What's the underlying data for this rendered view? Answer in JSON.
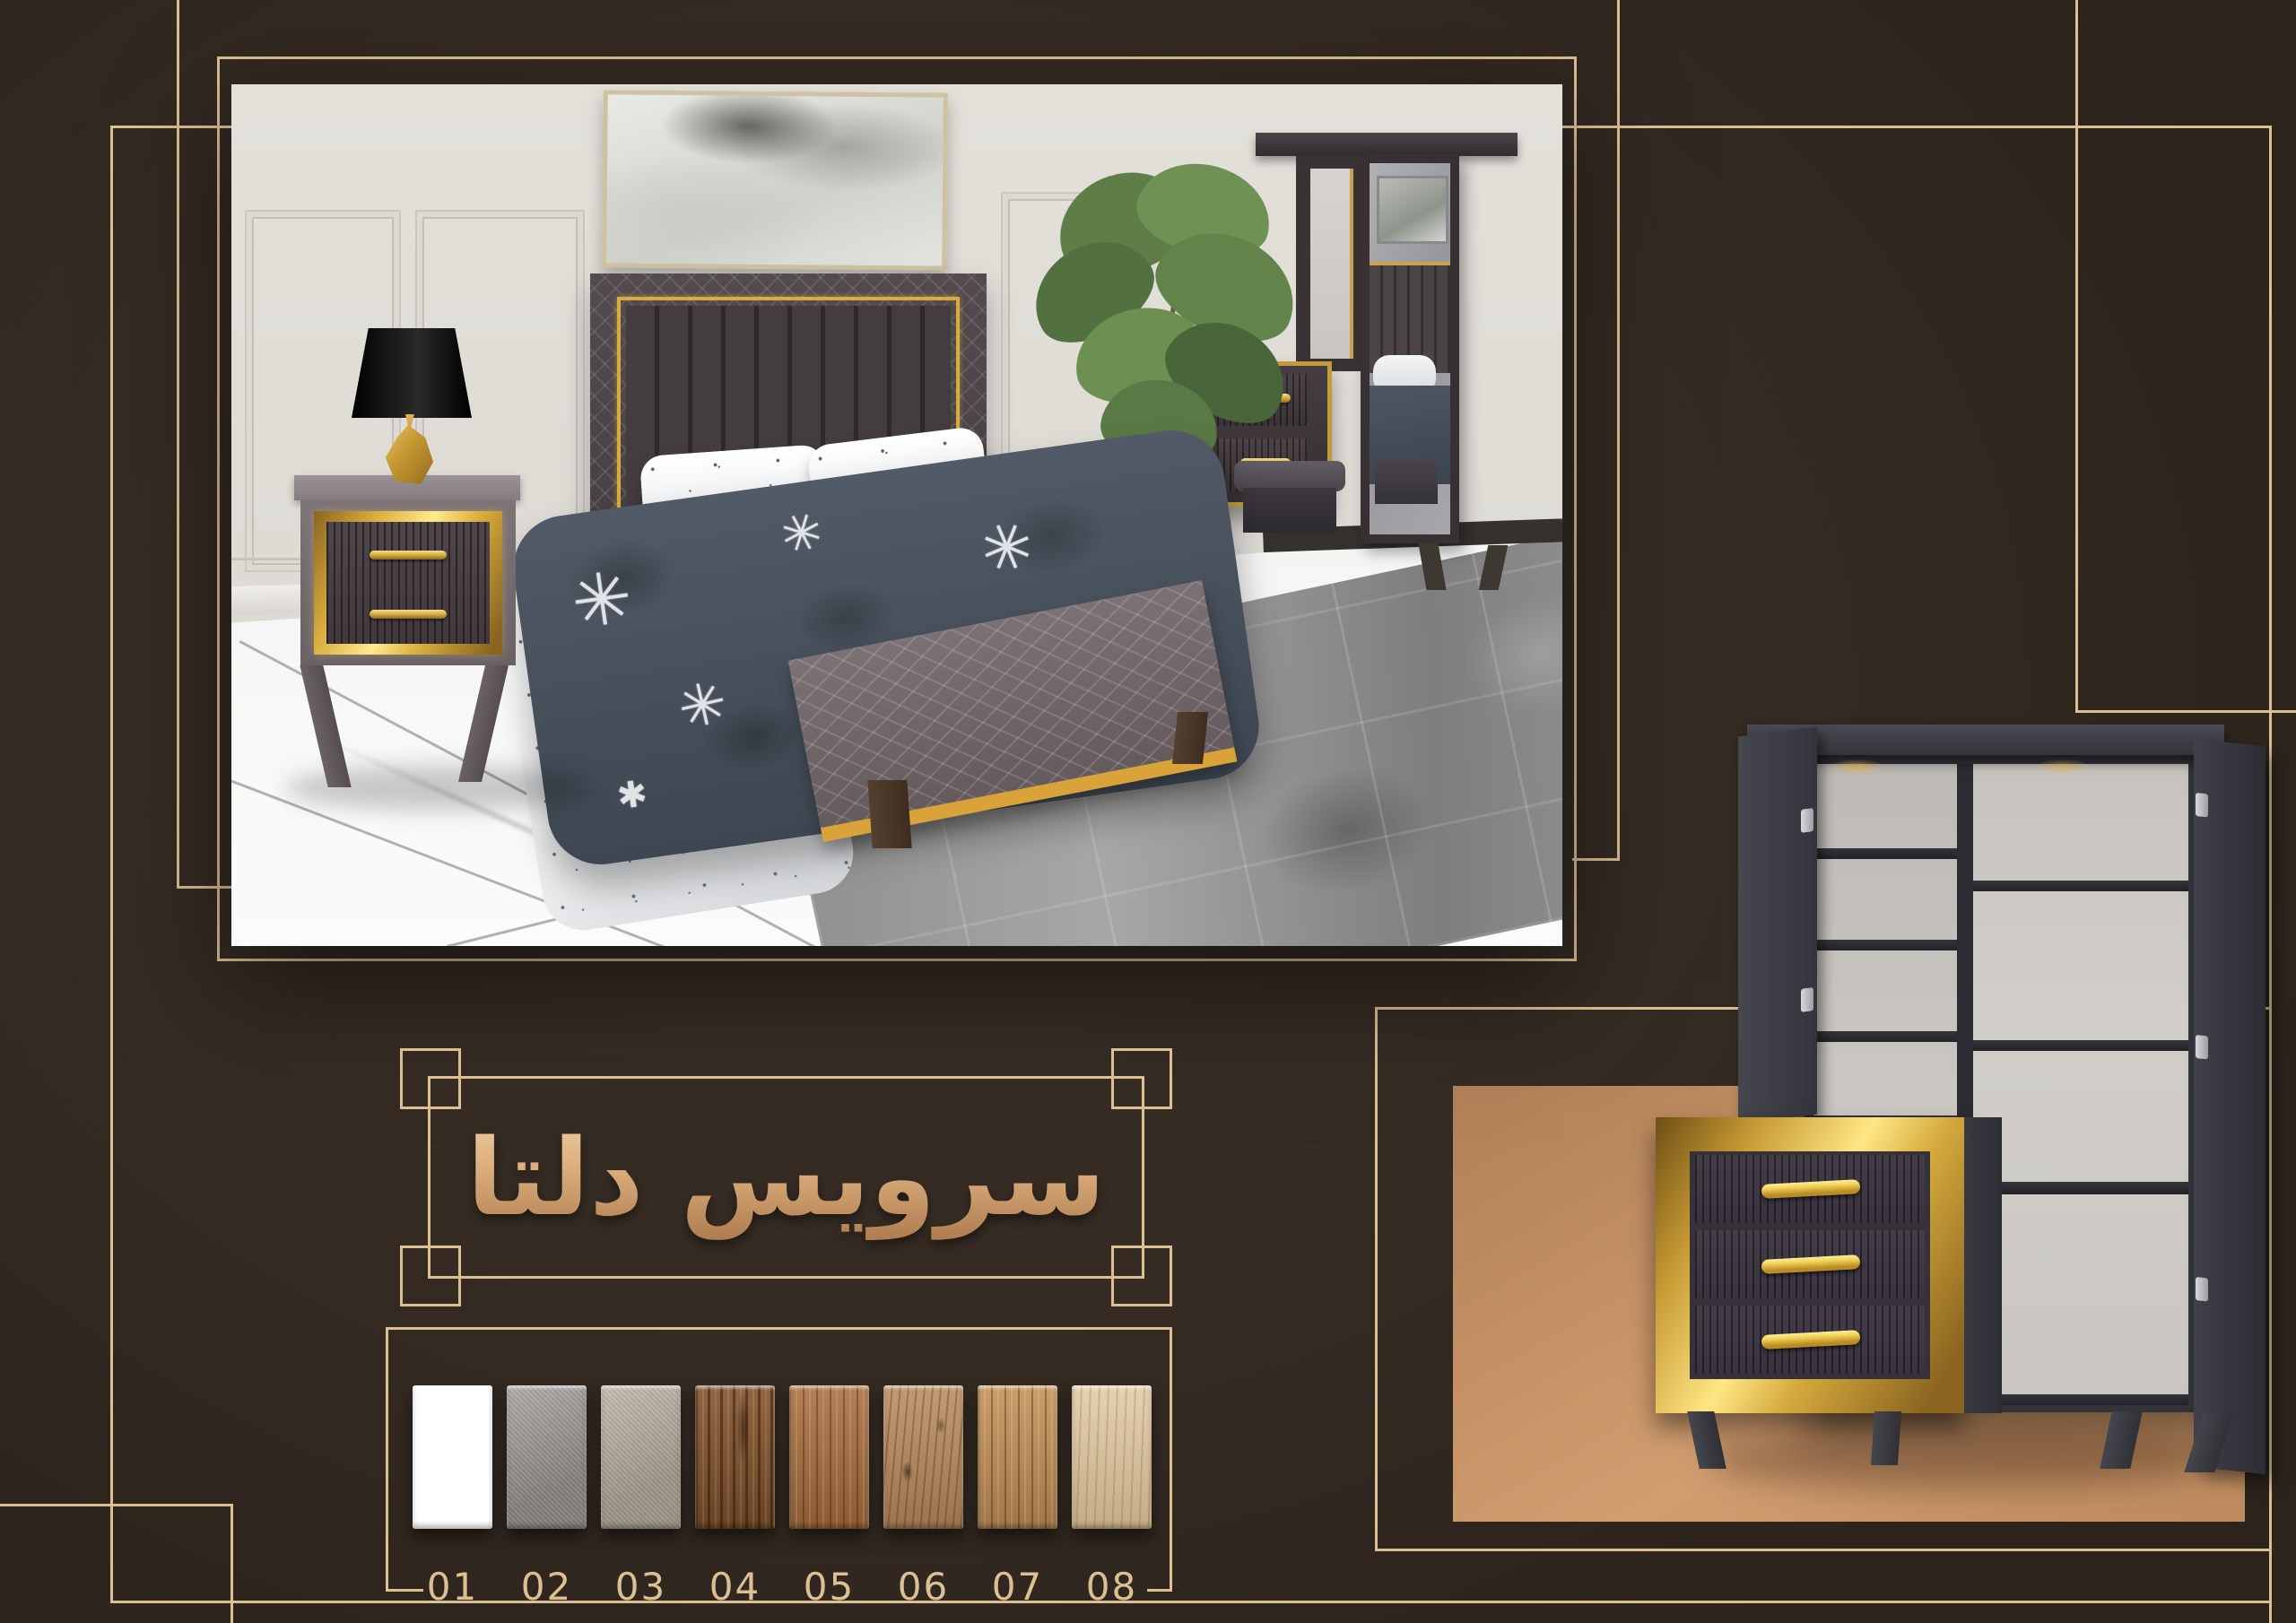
{
  "page": {
    "background_color": "#342a23",
    "accent_line_color": "#dcc094",
    "gold_accent_color": "#e8c14c",
    "copper_panel_color": "#c79467"
  },
  "title": {
    "text": "سرویس دلتا",
    "gradient_top": "#f5dcb2",
    "gradient_bottom": "#9d6a40"
  },
  "swatches": {
    "items": [
      {
        "label": "01",
        "color": "#ffffff",
        "finish": "plain"
      },
      {
        "label": "02",
        "color": "#97918d",
        "finish": "fabric"
      },
      {
        "label": "03",
        "color": "#b2a897",
        "finish": "fabric"
      },
      {
        "label": "04",
        "color": "#84552e",
        "finish": "wood-dark"
      },
      {
        "label": "05",
        "color": "#a96f40",
        "finish": "wood"
      },
      {
        "label": "06",
        "color": "#b78b5d",
        "finish": "wood-knot"
      },
      {
        "label": "07",
        "color": "#c39157",
        "finish": "wood"
      },
      {
        "label": "08",
        "color": "#dac095",
        "finish": "wood-light"
      }
    ]
  }
}
